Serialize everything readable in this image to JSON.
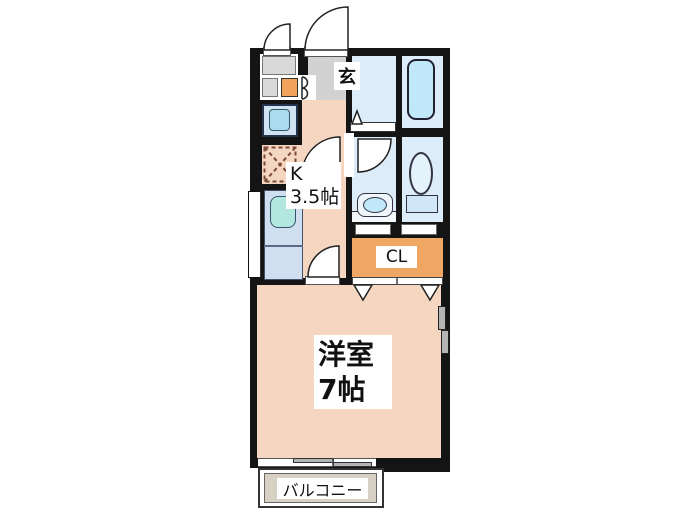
{
  "labels": {
    "entrance": "玄",
    "kitchen_type": "K",
    "kitchen_size": "3.5帖",
    "closet": "CL",
    "main_room_name": "洋室",
    "main_room_size": "7帖",
    "balcony": "バルコニー"
  },
  "colors": {
    "wall": "#141414",
    "floor-peach": "#f5d6c1",
    "genkan-gray": "#d2d2d2",
    "storage-gray": "#d9d9d9",
    "accent-orange": "#f1a35c",
    "closet-orange": "#efa763",
    "wet-blue": "#dcecf8",
    "tub-blue": "#c0e8f8",
    "fixture-blue": "#a9ddee",
    "counter-blue": "#cfdfef",
    "sink-teal": "#b2e7e0",
    "balcony-beige": "#d7d0c5",
    "window-gray": "#b4b4b4"
  }
}
